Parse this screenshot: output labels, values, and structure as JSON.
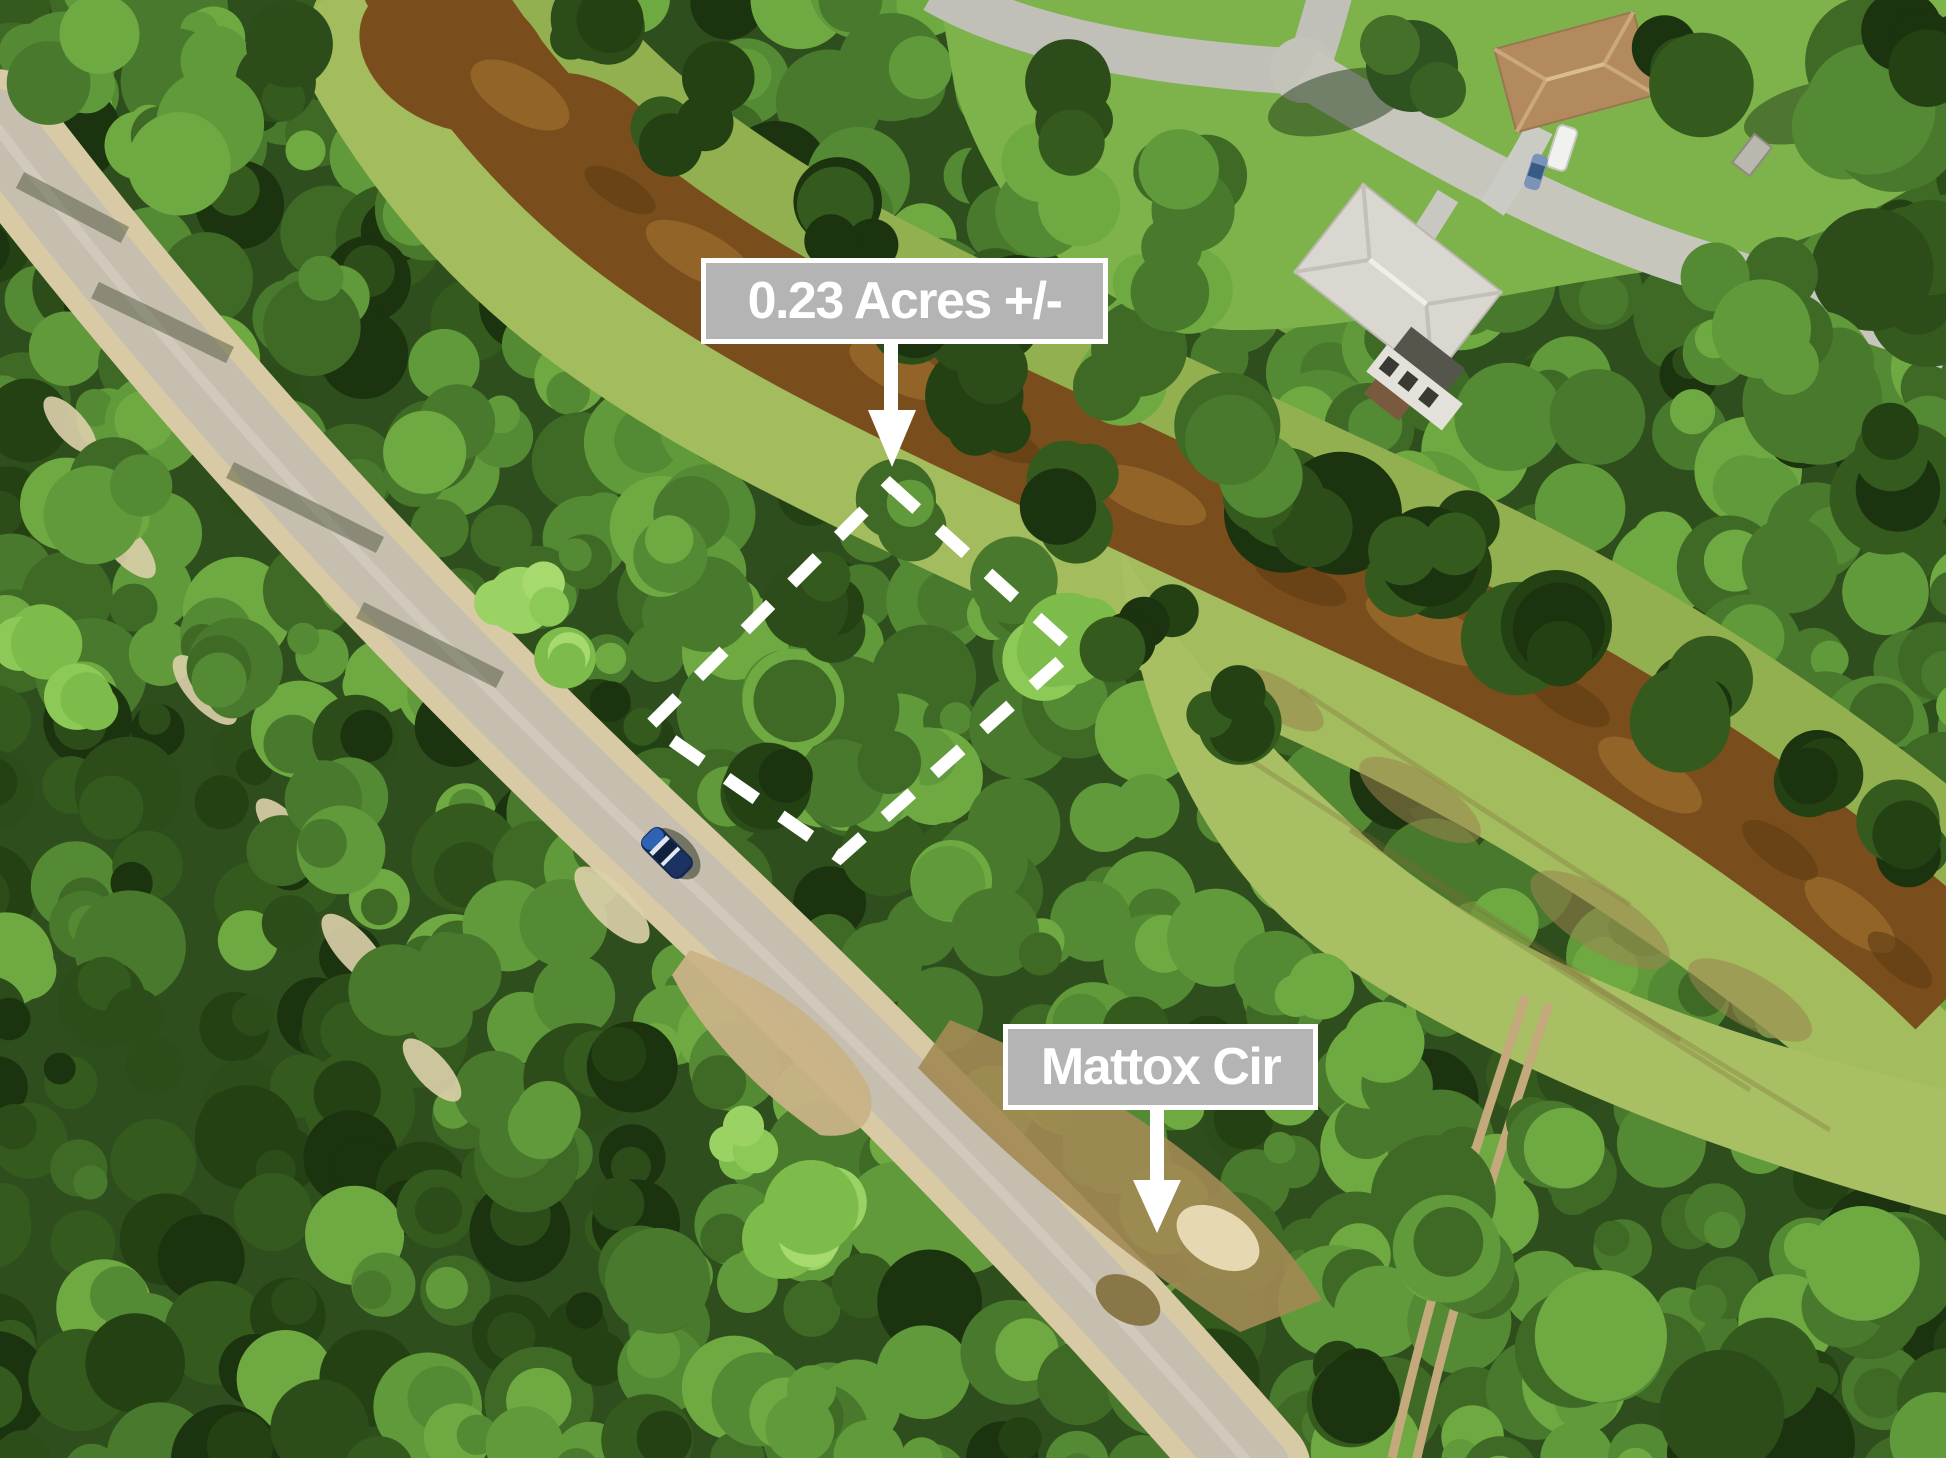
{
  "scene": {
    "type": "aerial-drone-photo",
    "subject": "Wooded vacant residential lot between a dirt road and a brown-water canal",
    "street_name": "Mattox Cir",
    "lot_size": "0.23 Acres +/-"
  },
  "annotations": {
    "acreage_label": {
      "text": "0.23 Acres +/-"
    },
    "street_label": {
      "text": "Mattox Cir"
    },
    "parcel_outline": {
      "points": "890,485 1073,650 840,857 650,725",
      "style": "dashed",
      "color": "#ffffff"
    },
    "label_style": {
      "background": "#b4b4b4",
      "border": "#ffffff",
      "text": "#ffffff"
    }
  },
  "palette": {
    "canal_water": "#7a4e1c",
    "road_surface": "#c6bfaf",
    "road_shoulder": "#d8caa4",
    "lawn": "#7eb24a",
    "grass_bank": "#a2bc5e",
    "meadow": "#a8bf63",
    "forest_dark": "#1c330f",
    "forest_mid": "#49792c",
    "forest_bright": "#8cc957",
    "car": "#16294f"
  }
}
